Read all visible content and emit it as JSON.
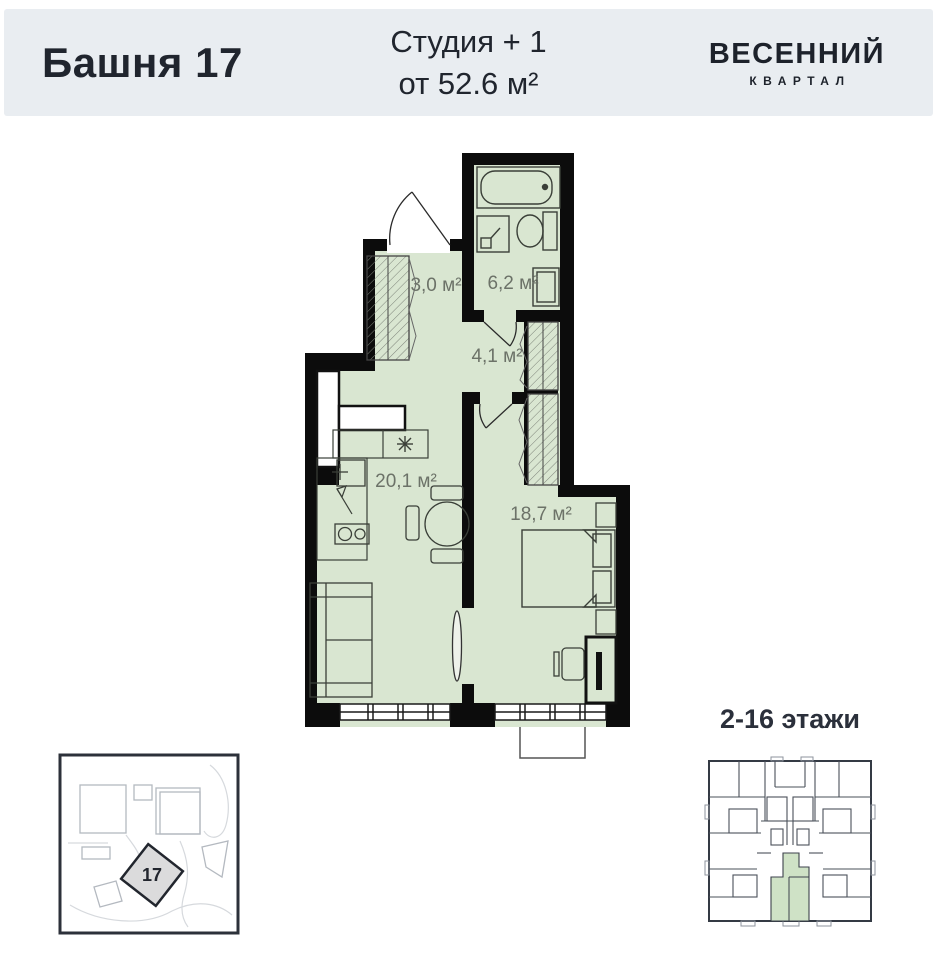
{
  "header": {
    "title": "Башня 17",
    "layout_type": "Студия + 1",
    "area_from": "от 52.6 м²",
    "logo": {
      "line1": "ВЕСЕННИЙ",
      "line2": "КВАРТАЛ"
    }
  },
  "plan": {
    "rooms": [
      {
        "name": "entry-hall",
        "area_label": "3,0 м²"
      },
      {
        "name": "bathroom",
        "area_label": "6,2 м²"
      },
      {
        "name": "corridor",
        "area_label": "4,1 м²"
      },
      {
        "name": "kitchen-living-room",
        "area_label": "20,1 м²"
      },
      {
        "name": "bedroom",
        "area_label": "18,7 м²"
      }
    ]
  },
  "site_plan": {
    "building_number": "17"
  },
  "floor_plate": {
    "floors_label": "2-16 этажи"
  },
  "colors": {
    "header_bg": "#e9edf1",
    "accent_text": "#20252e",
    "wall": "#0c0c0c",
    "floor_fill": "#d9e6d1",
    "room_label": "#6c7268",
    "unit_highlight": "#cfe2c6"
  }
}
